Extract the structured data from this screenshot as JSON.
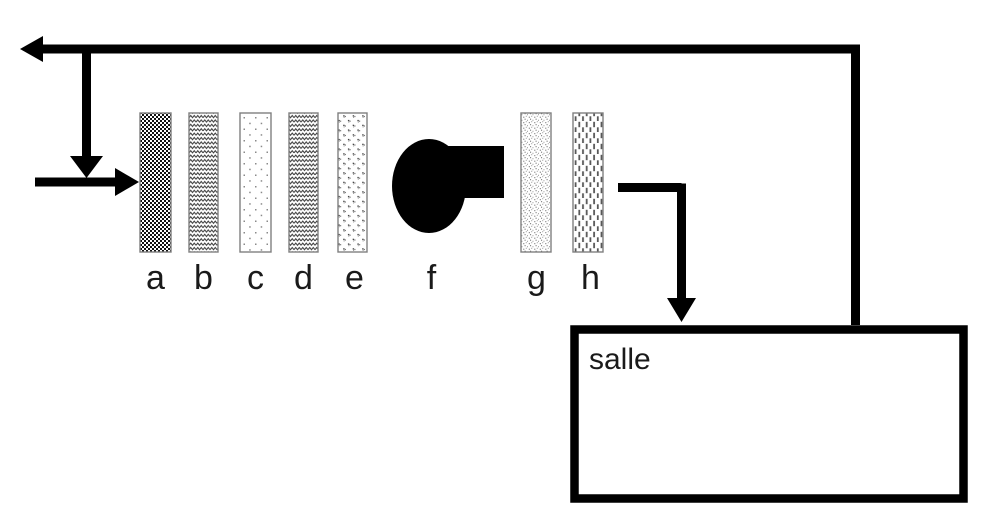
{
  "diagram": {
    "room": {
      "label": "salle"
    },
    "components": [
      {
        "id": "a",
        "label": "a",
        "pattern": "dense-checker"
      },
      {
        "id": "b",
        "label": "b",
        "pattern": "zigzag"
      },
      {
        "id": "c",
        "label": "c",
        "pattern": "sparse-dots"
      },
      {
        "id": "d",
        "label": "d",
        "pattern": "zigzag"
      },
      {
        "id": "e",
        "label": "e",
        "pattern": "dot-clusters"
      },
      {
        "id": "f",
        "label": "f",
        "pattern": "solid-black-fan"
      },
      {
        "id": "g",
        "label": "g",
        "pattern": "fine-speckle"
      },
      {
        "id": "h",
        "label": "h",
        "pattern": "vertical-dashes"
      }
    ],
    "colors": {
      "line": "#000000",
      "component_border": "#7f7f7f",
      "background": "#ffffff"
    }
  }
}
